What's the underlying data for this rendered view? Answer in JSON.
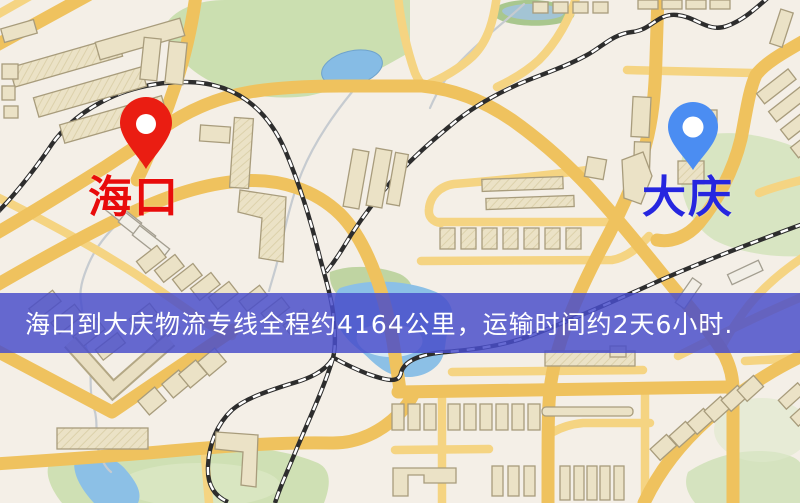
{
  "app": {
    "type": "map-screenshot"
  },
  "map": {
    "banner": {
      "text": "海口到大庆物流专线全程约4164公里，运输时间约2天6小时.",
      "bg_color": "#494dca",
      "text_color": "#ffffff"
    },
    "route": {
      "origin": "海口",
      "destination": "大庆",
      "distance": "约4164公里",
      "duration": "约2天6小时"
    },
    "markers": [
      {
        "id": "origin",
        "label": "海口",
        "pin_color": "#ea1d12",
        "label_color": "#e80b0b",
        "pin_style": "red-teardrop"
      },
      {
        "id": "destination",
        "label": "大庆",
        "pin_color": "#4b8df2",
        "label_color": "#2626df",
        "pin_style": "blue-rounded-teardrop"
      }
    ],
    "palette": {
      "background": "#f4efe7",
      "road_major": "#efc25e",
      "road_minor": "#f5d482",
      "building_fill": "#ebe2c6",
      "building_stroke": "#a89c7c",
      "park_green": "#cbdfb0",
      "water_blue": "#8cc0e6",
      "railway": "#2d2d2d"
    }
  }
}
